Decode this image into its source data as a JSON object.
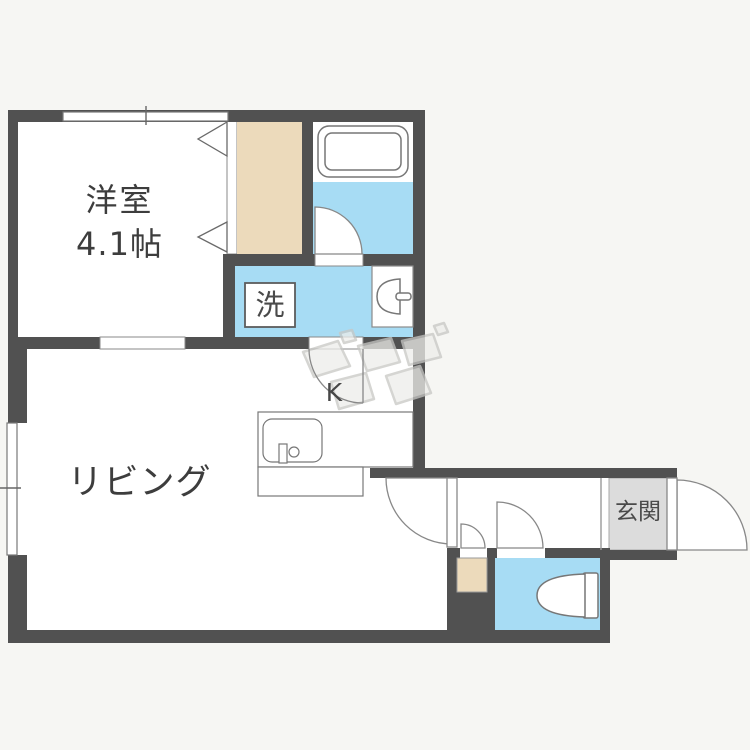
{
  "rooms": {
    "western_room": {
      "label": "洋室",
      "size": "4.1帖"
    },
    "living": {
      "label": "リビング"
    },
    "kitchen": {
      "label": "K"
    },
    "laundry": {
      "label": "洗"
    },
    "entrance": {
      "label": "玄関"
    }
  },
  "colors": {
    "wall": "#515151",
    "water_area": "#a7dcf4",
    "closet": "#ecdabb",
    "entrance_tile": "#dcdcdc",
    "background": "#f6f6f3",
    "outline": "#7a7a7a",
    "text": "#3d3d3d"
  }
}
